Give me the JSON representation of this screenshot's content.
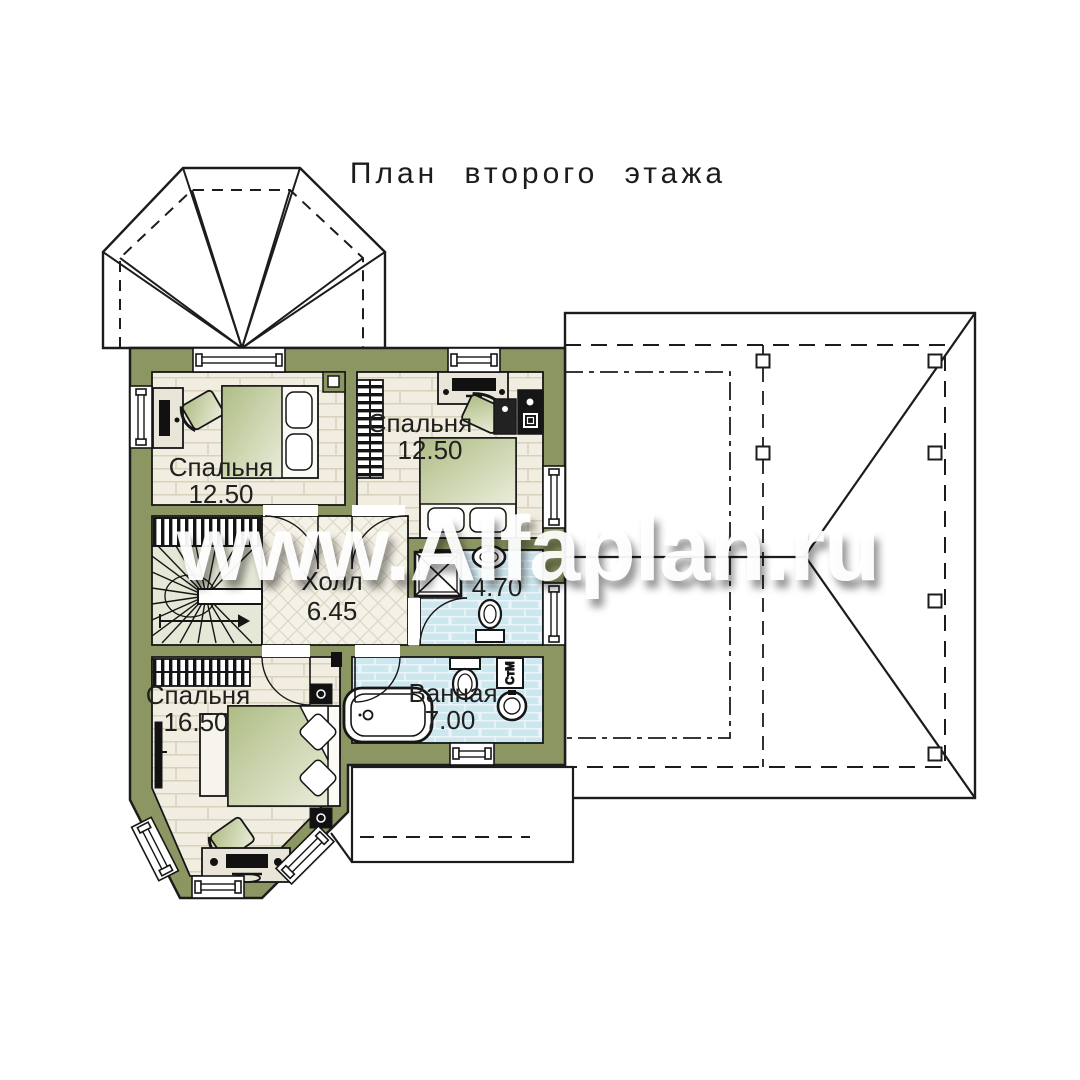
{
  "title": "План второго этажа",
  "watermark": "www.Alfaplan.ru",
  "rooms": {
    "bedroom1": {
      "name": "Спальня",
      "area": "12.50"
    },
    "bedroom2": {
      "name": "Спальня",
      "area": "12.50"
    },
    "bedroom3": {
      "name": "Спальня",
      "area": "16.50"
    },
    "hall": {
      "name": "Холл",
      "area": "6.45"
    },
    "bathroom": {
      "name": "Ванная",
      "area": "7.00"
    },
    "wc": {
      "area": "4.70"
    }
  },
  "labels": {
    "washing_machine": "СтМ"
  },
  "colors": {
    "wall_green": "#8B9663",
    "floor_cream": "#F1EEE1",
    "tile_blue": "#CDE7EF",
    "furniture_sage": "#B3C08A",
    "line_black": "#1C1C1C",
    "watermark_white": "#FFFFFF"
  }
}
